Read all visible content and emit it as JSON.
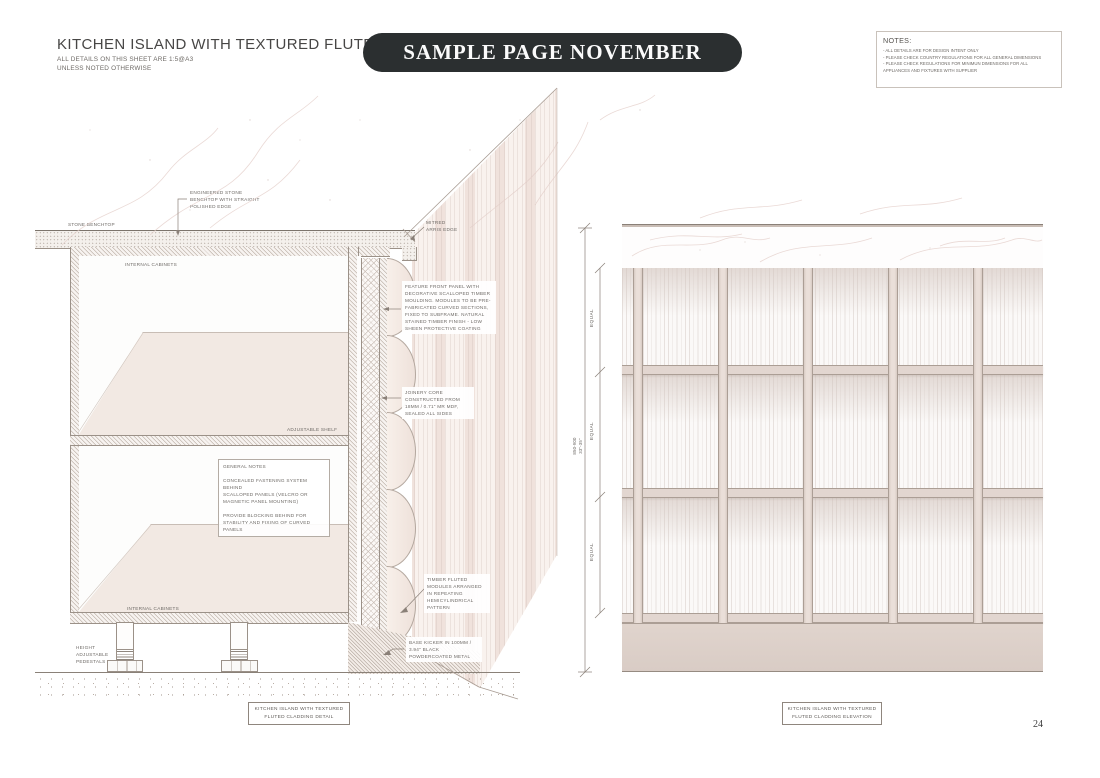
{
  "header": {
    "title": "KITCHEN ISLAND WITH TEXTURED FLUTED CLADDING",
    "subtitle_line1": "ALL DETAILS ON THIS SHEET ARE 1:5@A3",
    "subtitle_line2": "UNLESS NOTED OTHERWISE"
  },
  "banner": {
    "label": "SAMPLE PAGE NOVEMBER",
    "bg_color": "#2b2f30",
    "text_color": "#fbfbfb"
  },
  "notes_box": {
    "title": "NOTES:",
    "items": [
      "- ALL DETAILS ARE FOR DESIGN INTENT ONLY",
      "- PLEASE CHECK COUNTRY REGULATIONS FOR ALL GENERAL DIMENSIONS",
      "- PLEASE CHECK REGULATIONS FOR MINIMUN DIMENSIONS FOR ALL\n  APPLIANCES AND FIXTURES WITH SUPPLIER"
    ]
  },
  "detail_drawing": {
    "labels": {
      "stone_benchtop": "STONE BENCHTOP",
      "engineered_stone": "ENGINEERED STONE\nBENCHTOP WITH STRAIGHT\nPOLISHED EDGE",
      "mitred_arris": "MITRED\nARRIS EDGE",
      "internal_cabinets_top": "INTERNAL CABINETS",
      "internal_cabinets_bottom": "INTERNAL CABINETS",
      "adjustable_shelf": "ADJUSTABLE SHELF",
      "feature_front_panel": "FEATURE FRONT PANEL WITH\nDECORATIVE SCALLOPED TIMBER\nMOULDING. MODULES TO BE PRE-\nFABRICATED CURVED SECTIONS,\nFIXED TO SUBFRAME. NATURAL\nSTAINED TIMBER FINISH - LOW\nSHEEN PROTECTIVE COATING",
      "joinery_core": "JOINERY CORE\nCONSTRUCTED FROM\n18MM / 0.71\" MR MDF,\nSEALED ALL SIDES",
      "general_notes": "GENERAL NOTES\n\nCONCEALED FASTENING SYSTEM BEHIND\nSCALLOPED PANELS (VELCRO OR\nMAGNETIC PANEL MOUNTING)\n\nPROVIDE BLOCKING BEHIND FOR\nSTABILITY AND FIXING OF CURVED PANELS",
      "timber_fluted": "TIMBER FLUTED\nMODULES ARRANGED\nIN REPEATING\nHEMICYLINDRICAL\nPATTERN",
      "base_kicker": "BASE KICKER IN 100MM /\n3.94\" BLACK\nPOWDERCOATED METAL",
      "height_pedestals": "HEIGHT\nADJUSTABLE\nPEDESTALS"
    },
    "caption": "KITCHEN ISLAND WITH TEXTURED\nFLUTED CLADDING DETAIL"
  },
  "elevation_drawing": {
    "dimensions": {
      "overall_mm": "850-900",
      "overall_in": "33\"-35\"",
      "equal_segments": [
        "EQUAL",
        "EQUAL",
        "EQUAL"
      ]
    },
    "caption": "KITCHEN ISLAND WITH TEXTURED\nFLUTED CLADDING ELEVATION"
  },
  "page_number": "24",
  "palette": {
    "banner_bg": "#2b2f30",
    "line": "#9b9188",
    "beige_fill": "#e2d6d0",
    "panel_fill": "#f2e9e3",
    "vein": "#e3cdc8"
  }
}
